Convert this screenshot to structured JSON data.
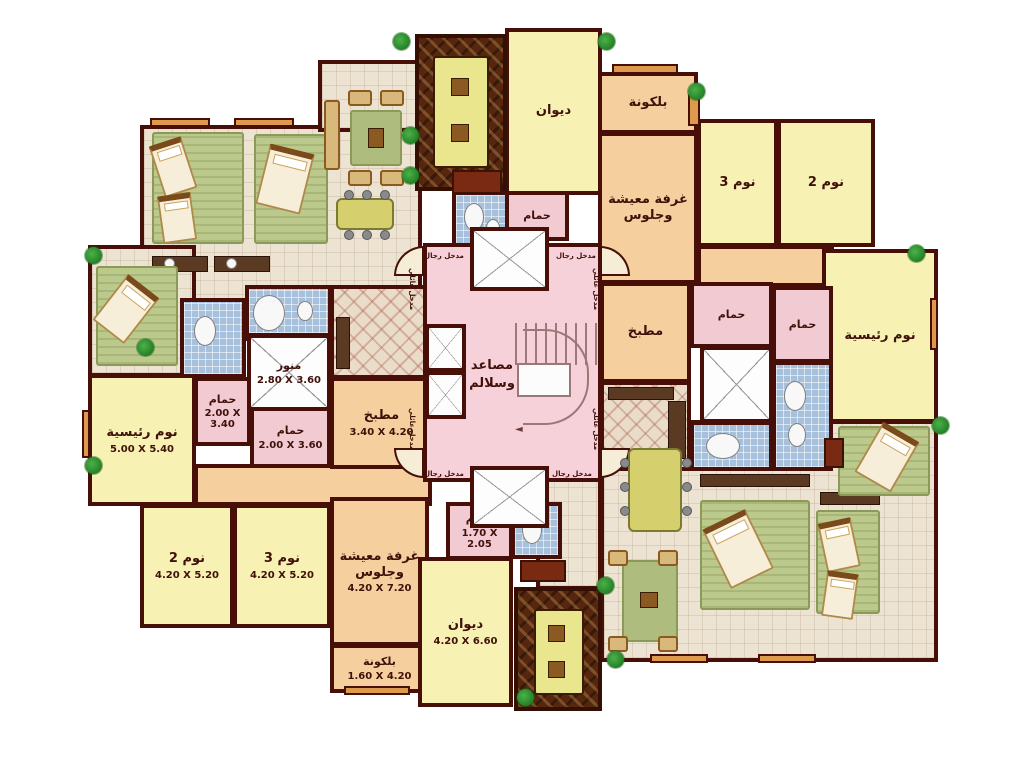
{
  "title": "Residential building typical floor plan (Arabic)",
  "palette": {
    "wall": "#470f08",
    "room_yellow": "#f7f2b4",
    "room_tan": "#f5cf9e",
    "room_pink": "#f2cbd2",
    "core_pink": "#f6d1d9",
    "bath_blue": "#a7c1dc",
    "wood_brown": "#56270e",
    "tile_beige": "#ece3d3",
    "plant_green": "#1f8a1f",
    "ledge_orange": "#dd9a4d"
  },
  "rooms": [
    {
      "id": "diwan-top",
      "label": "ديوان",
      "dims": ""
    },
    {
      "id": "hammam-top",
      "label": "حمام",
      "dims": ""
    },
    {
      "id": "balcony-top-right",
      "label": "بلكونة",
      "dims": ""
    },
    {
      "id": "living-top-right",
      "label": "غرفة معيشة وجلوس",
      "dims": ""
    },
    {
      "id": "bedroom3-top-right",
      "label": "نوم 3",
      "dims": ""
    },
    {
      "id": "bedroom2-top-right",
      "label": "نوم 2",
      "dims": ""
    },
    {
      "id": "master-right",
      "label": "نوم رئيسية",
      "dims": ""
    },
    {
      "id": "kitchen-right",
      "label": "مطبخ",
      "dims": ""
    },
    {
      "id": "hammam-right-1",
      "label": "حمام",
      "dims": ""
    },
    {
      "id": "hammam-right-2",
      "label": "حمام",
      "dims": ""
    },
    {
      "id": "lightwell-left",
      "label": "منور",
      "dims": "2.80 X 3.60"
    },
    {
      "id": "hammam-left-1",
      "label": "حمام",
      "dims": "2.00 X 3.40"
    },
    {
      "id": "hammam-left-2",
      "label": "حمام",
      "dims": "2.00 X 3.60"
    },
    {
      "id": "kitchen-left",
      "label": "مطبخ",
      "dims": "3.40 X 4.20"
    },
    {
      "id": "master-left",
      "label": "نوم رئيسية",
      "dims": "5.00 X 5.40"
    },
    {
      "id": "bedroom2-bottom-left",
      "label": "نوم 2",
      "dims": "4.20 X 5.20"
    },
    {
      "id": "bedroom3-bottom-left",
      "label": "نوم 3",
      "dims": "4.20 X 5.20"
    },
    {
      "id": "living-bottom-left",
      "label": "غرفة معيشة وجلوس",
      "dims": "4.20 X 7.20"
    },
    {
      "id": "balcony-bottom-left",
      "label": "بلكونة",
      "dims": "1.60 X 4.20"
    },
    {
      "id": "hammam-bottom",
      "label": "حمام",
      "dims": "1.70 X 2.05"
    },
    {
      "id": "diwan-bottom",
      "label": "ديوان",
      "dims": "4.20 X 6.60"
    }
  ],
  "core": {
    "line1": "مصاعد",
    "line2": "وسلالم"
  },
  "entrances": {
    "men": "مدخل رجال",
    "family": "مدخل عائلي"
  }
}
